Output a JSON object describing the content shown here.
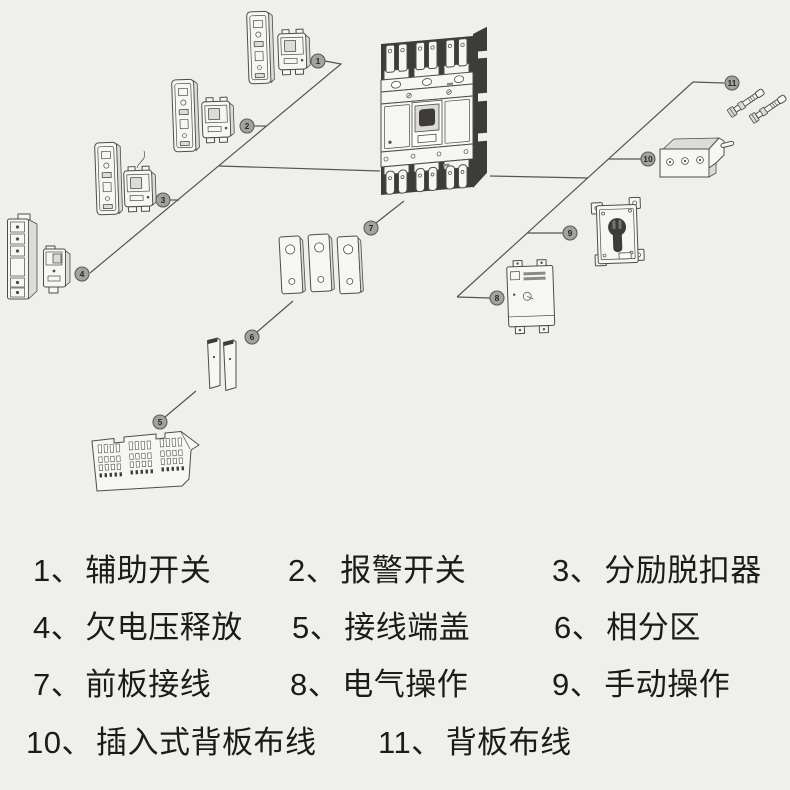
{
  "colors": {
    "background": "#efefed",
    "line_art": "#4e4d48",
    "dark_fill": "#3d3c39",
    "part_fill": "#f6f6f3",
    "badge_fill": "#a3a29e",
    "text": "#1c1b19"
  },
  "diagram": {
    "callouts": [
      "1",
      "2",
      "3",
      "4",
      "5",
      "6",
      "7",
      "8",
      "9",
      "10",
      "11"
    ]
  },
  "legend": {
    "items": [
      {
        "num": "1、",
        "label": "辅助开关"
      },
      {
        "num": "2、",
        "label": "报警开关"
      },
      {
        "num": "3、",
        "label": "分励脱扣器"
      },
      {
        "num": "4、",
        "label": "欠电压释放"
      },
      {
        "num": "5、",
        "label": "接线端盖"
      },
      {
        "num": "6、",
        "label": "相分区"
      },
      {
        "num": "7、",
        "label": "前板接线"
      },
      {
        "num": "8、",
        "label": "电气操作"
      },
      {
        "num": "9、",
        "label": "手动操作"
      },
      {
        "num": "10、",
        "label": "插入式背板布线"
      },
      {
        "num": "11、",
        "label": "背板布线"
      }
    ]
  }
}
